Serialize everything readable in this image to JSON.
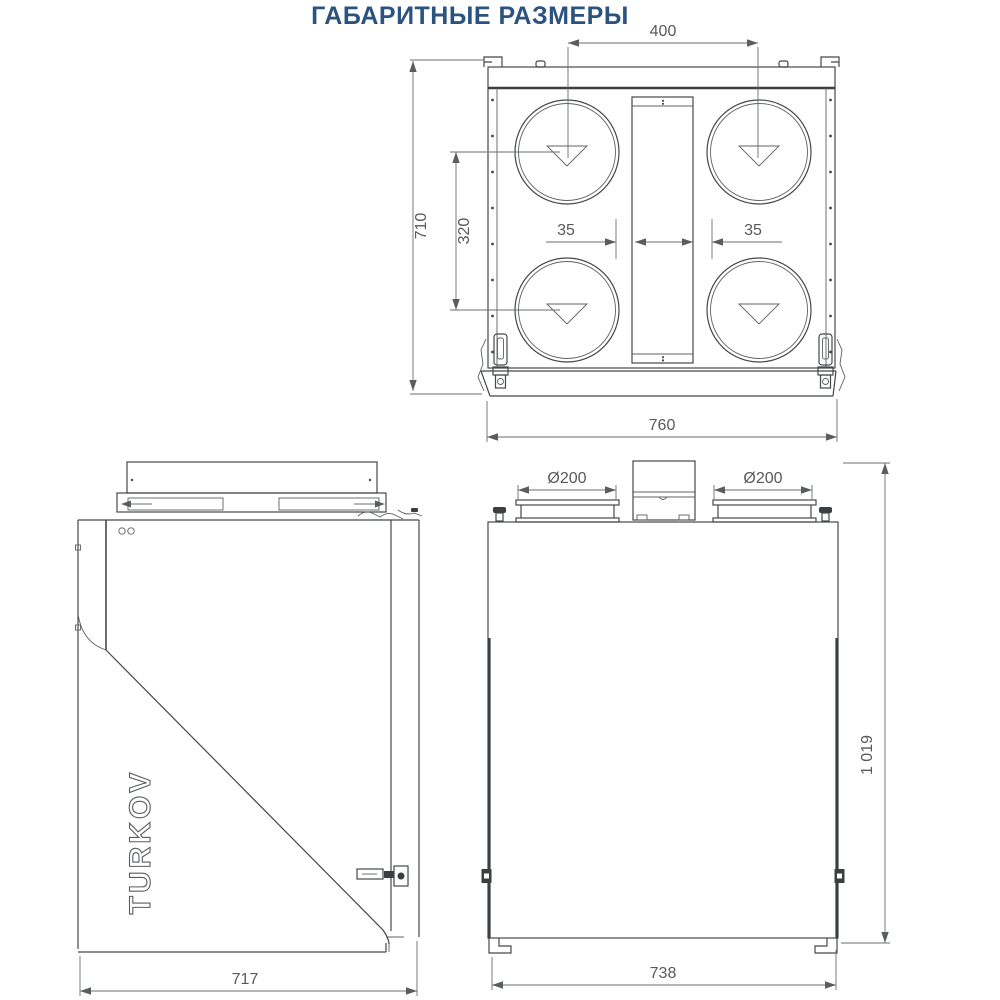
{
  "title": "ГАБАРИТНЫЕ РАЗМЕРЫ",
  "logo_text": "TURKOV",
  "colors": {
    "title": "#2b5380",
    "line": "#45484b",
    "dim_text": "#58595b"
  },
  "top_view": {
    "dim_400": "400",
    "dim_710": "710",
    "dim_320": "320",
    "dim_35_left": "35",
    "dim_35_right": "35",
    "dim_760": "760"
  },
  "side_view": {
    "dim_717": "717"
  },
  "front_view": {
    "dim_d200_left": "Ø200",
    "dim_d200_right": "Ø200",
    "dim_1019": "1 019",
    "dim_738": "738"
  }
}
